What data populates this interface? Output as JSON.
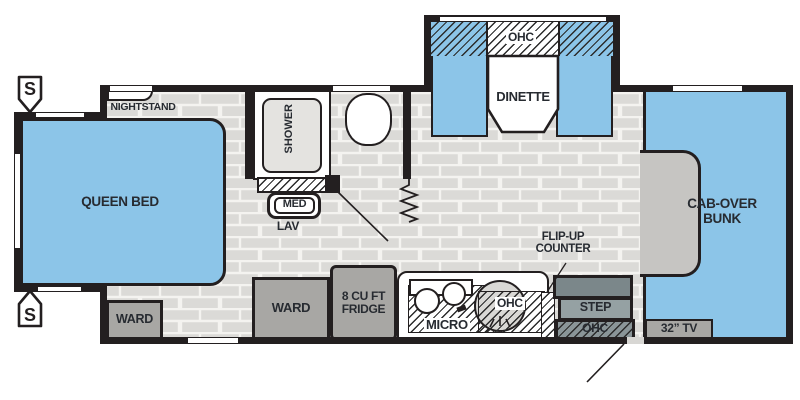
{
  "labels": {
    "nightstand": "NIGHTSTAND",
    "queen_bed": "QUEEN BED",
    "bed_ward": "WARD",
    "speaker": "S",
    "shower": "SHOWER",
    "med": "MED",
    "lav": "LAV",
    "dinette_ohc": "OHC",
    "dinette": "DINETTE",
    "kitchen_ward": "WARD",
    "fridge_line1": "8 CU FT",
    "fridge_line2": "FRIDGE",
    "micro": "MICRO",
    "kitchen_ohc": "OHC",
    "flip_up_line1": "FLIP-UP",
    "flip_up_line2": "COUNTER",
    "step": "STEP",
    "entry_ohc": "OHC",
    "tv": "32” TV",
    "bunk_line1": "CAB-OVER",
    "bunk_line2": "BUNK"
  },
  "colors": {
    "furniture_blue": "#8CC5E8",
    "cabinet_gray": "#A8A7A4",
    "floor_brick": "#DBDAD7",
    "mortar": "#F4F3F0",
    "wall_black": "#231F20",
    "step_slate": "#95A1A3",
    "step_dark_slate": "#7B878A",
    "notch_gray": "#C6C5C2",
    "shower_gray": "#E4E3E0",
    "sink_gray": "#D9D8D5"
  }
}
